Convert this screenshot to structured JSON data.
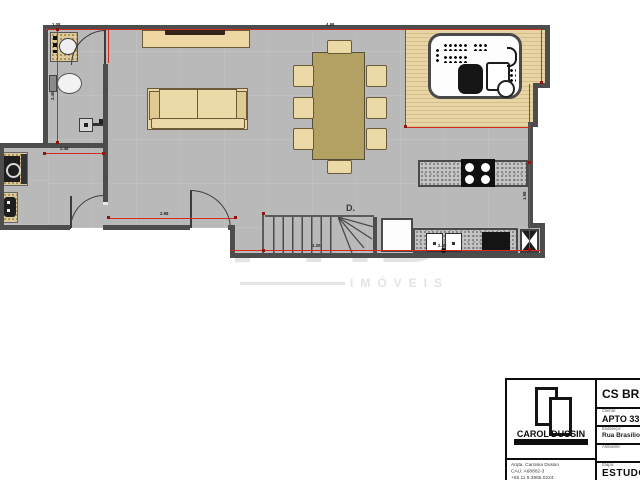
{
  "plan": {
    "stairs_label": "D.",
    "dims": [
      {
        "v": "1.08"
      },
      {
        "v": "4.98"
      },
      {
        "v": "2.40"
      },
      {
        "v": "2.48"
      },
      {
        "v": "2.98"
      },
      {
        "v": "1.20"
      },
      {
        "v": "2.40"
      },
      {
        "v": "1.98"
      }
    ]
  },
  "watermark": {
    "text": "PHD",
    "subtext": "IMÓVEIS"
  },
  "titleblock": {
    "logo_name": "CAROL DUSSIN",
    "project": "CS BRA",
    "client_label": "Cliente:",
    "client_value": "APTO 33",
    "address_label": "Endereço:",
    "address_value": "Rua Brasílio M",
    "room_label": "Ambiente:",
    "stage_label": "Etapa:",
    "stage_value": "ESTUDO",
    "architect": "Arqta. Carolina Dussin",
    "cau": "CAU: A68802-3",
    "phone": "+55 11 9.3965.0224"
  },
  "colors": {
    "dimension_red": "#d22b20",
    "wall": "#4d4d4d",
    "floor": "#b9b9b9",
    "deck_wood": "#e3cf9e",
    "furniture_beige": "#ecd9a8",
    "table_khaki": "#b2a163"
  }
}
